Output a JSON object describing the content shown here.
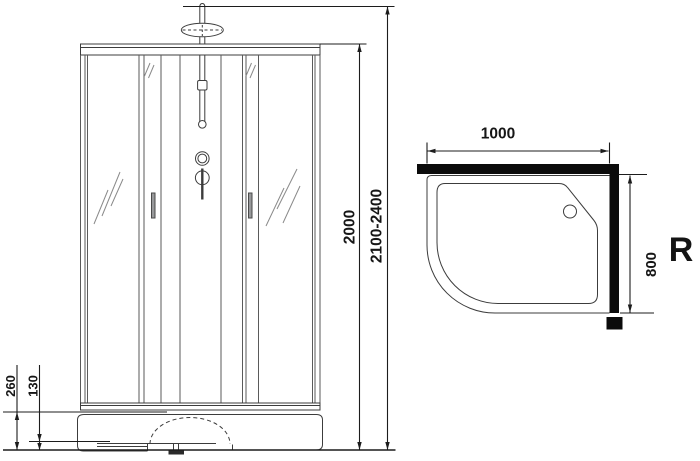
{
  "front_view": {
    "overall_height_label": "2100-2400",
    "cabin_height_label": "2000",
    "tray_height_label": "260",
    "tray_step_label": "130"
  },
  "top_view": {
    "width_label": "1000",
    "depth_label": "800",
    "orientation_label": "R"
  },
  "colors": {
    "structure_line": "#3c3c3c",
    "dimension_line": "#1c1c1c",
    "text": "#161616",
    "wall_fill": "#0b0b0b",
    "handle_fill": "#98999b",
    "hatch_stroke": "#8a8a8a",
    "foot_fill": "#2a2a2a"
  }
}
